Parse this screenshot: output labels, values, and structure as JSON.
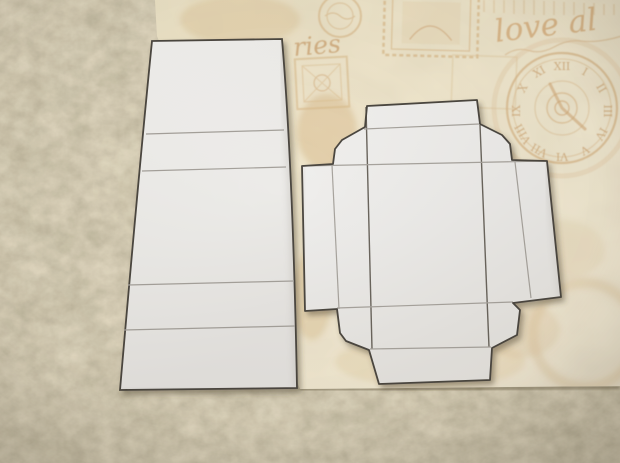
{
  "scene": {
    "setting": "two white paper craft box templates photographed lying on vintage scrapbook paper over beige carpet",
    "objects": [
      "beige carpet",
      "cream scrapbook paper with stamp and clock motifs",
      "tall rectangular fold template with four crease lines",
      "cross-shaped box template with flaps, gussets and end tabs"
    ]
  },
  "carpet": {
    "base_color": "#b7a888"
  },
  "paper": {
    "base_color": "#ece4cb",
    "motif_color": "#d9b88c",
    "script_main": "love al",
    "script_partial": "ries"
  },
  "templates": {
    "left": {
      "fold_line_count": 4,
      "fill": "#f1f0ee",
      "outline": "#4c4741"
    },
    "box": {
      "fill": "#f0efec",
      "outline": "#4c4741"
    }
  },
  "clock": {
    "numeral_color": "#cfa878",
    "numerals": [
      "XII",
      "I",
      "II",
      "III",
      "IV",
      "V",
      "VI",
      "VII",
      "VIII",
      "IX",
      "X",
      "XI"
    ]
  }
}
